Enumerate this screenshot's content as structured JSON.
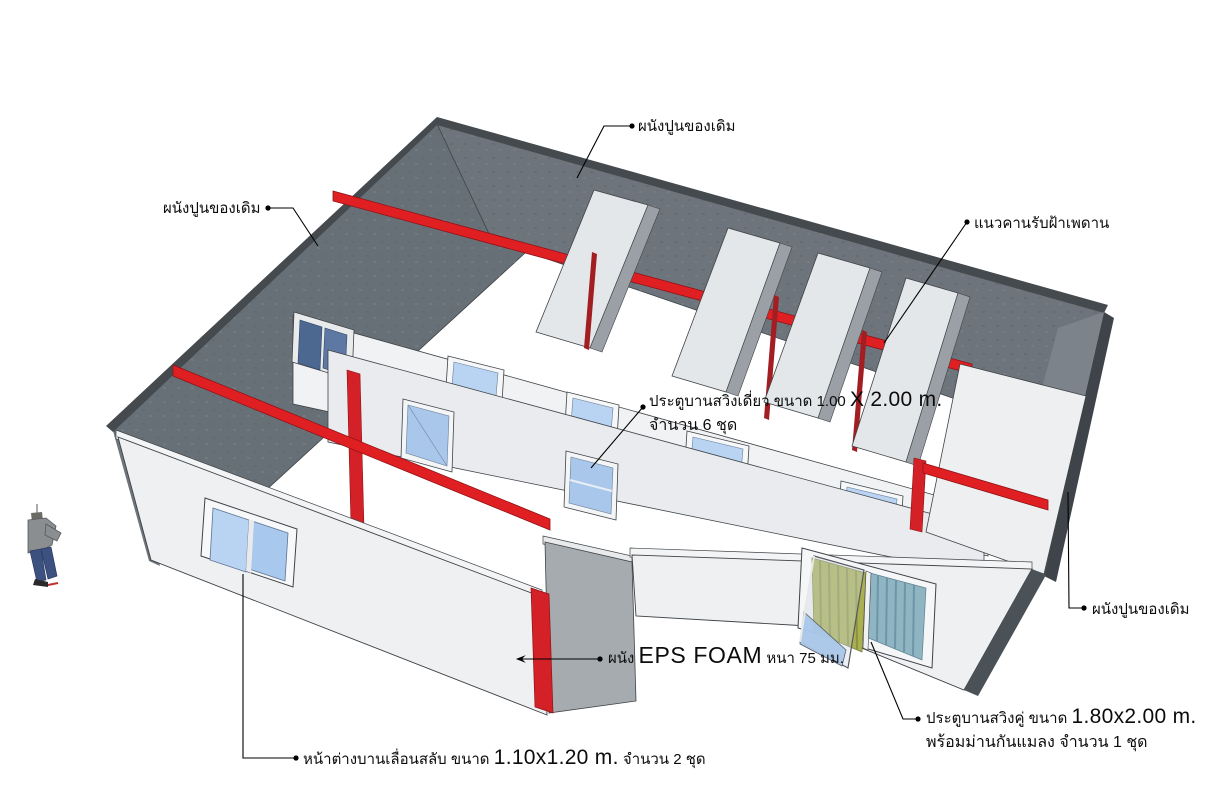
{
  "scene": {
    "type": "3d-architectural-model",
    "background": "#ffffff",
    "colors": {
      "existing_wall": "#6d747b",
      "existing_wall_left": "#687077",
      "existing_wall_dark": "#454a4f",
      "partition_face": "#eef0f2",
      "partition_shadow": "#a6abb0",
      "beam_red": "#e01f23",
      "strip_red": "#d32127",
      "accent_red_dark": "#a21e22",
      "window_glass": "#b9d3f2",
      "window_glass_dark": "#4c6890",
      "door_glass": "#a9c7ea",
      "curtain_olive": "#aab04f",
      "curtain_blue": "#8fb4c2",
      "outline": "#3f4347"
    }
  },
  "labels": {
    "wall_top": {
      "text": "ผนังปูนของเดิม"
    },
    "wall_left": {
      "text": "ผนังปูนของเดิม"
    },
    "wall_right": {
      "text": "ผนังปูนของเดิม"
    },
    "ceiling_beam": {
      "text": "แนวคานรับฝ้าเพดาน"
    },
    "single_door": {
      "prefix": "ประตูบานสวิงเดี่ยว ขนาด 1.00",
      "size": "X 2.00 m.",
      "line2": "จำนวน 6 ชุด"
    },
    "eps_wall": {
      "prefix": "ผนัง",
      "material": "EPS FOAM",
      "suffix": "หนา 75 มม."
    },
    "sliding_window": {
      "prefix": "หน้าต่างบานเลื่อนสลับ ขนาด",
      "size": "1.10x1.20 m.",
      "suffix": "จำนวน 2 ชุด"
    },
    "double_door": {
      "prefix": "ประตูบานสวิงคู่ ขนาด",
      "size": "1.80x2.00 m.",
      "line2": "พร้อมม่านกันแมลง จำนวน 1 ชุด"
    }
  }
}
